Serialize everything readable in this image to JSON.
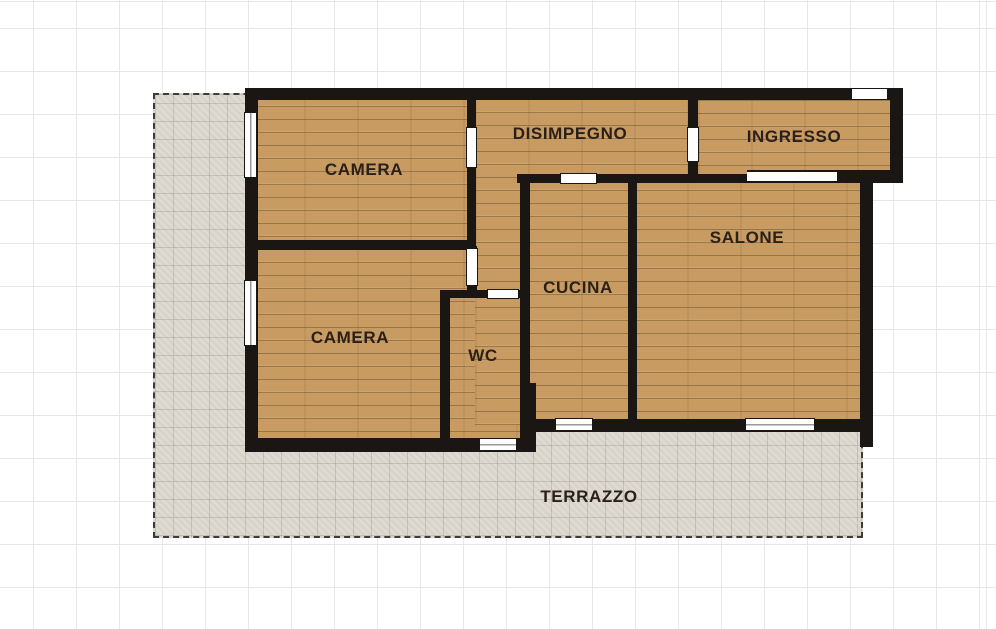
{
  "plan": {
    "rooms": [
      {
        "id": "camera-1",
        "label": "CAMERA"
      },
      {
        "id": "camera-2",
        "label": "CAMERA"
      },
      {
        "id": "disimpegno",
        "label": "DISIMPEGNO"
      },
      {
        "id": "ingresso",
        "label": "INGRESSO"
      },
      {
        "id": "salone",
        "label": "SALONE"
      },
      {
        "id": "cucina",
        "label": "CUCINA"
      },
      {
        "id": "wc",
        "label": "WC"
      },
      {
        "id": "terrazzo",
        "label": "TERRAZZO"
      }
    ],
    "features": {
      "windows": [
        "camera-1-left",
        "camera-2-left",
        "wc-bottom",
        "cucina-bottom",
        "salone-bottom"
      ],
      "doors": [
        "entry-top",
        "camera-1",
        "camera-2",
        "wc",
        "cucina",
        "disimpegno-ingresso"
      ],
      "openings": [
        "ingresso-salone-passage"
      ]
    },
    "colors": {
      "wall": "#1a1613",
      "wood_floor": "#c89b63",
      "wood_plank_line": "#9e7b4b",
      "terrace": "#d8d4cb",
      "terrace_grid": "#bdb9b0",
      "label_text": "#2b2018",
      "grid_line": "#e7e7e7",
      "background": "#ffffff"
    }
  }
}
